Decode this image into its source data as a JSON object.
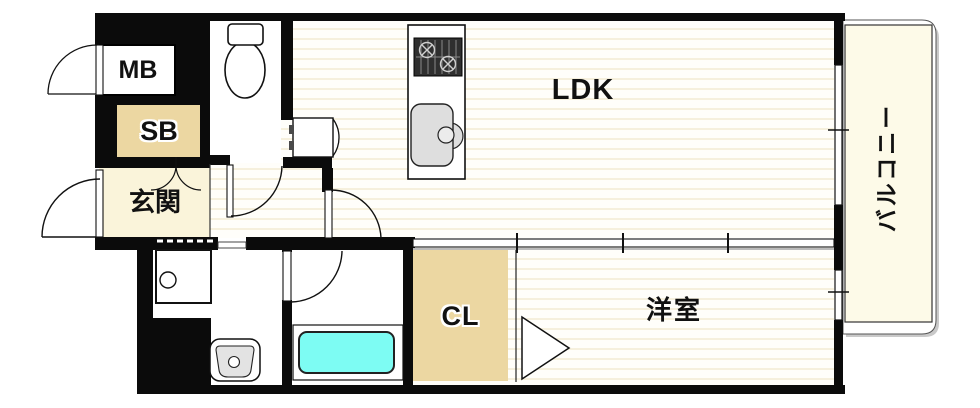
{
  "floorplan": {
    "unit_labels": {
      "mb": "MB",
      "sb": "SB",
      "genkan": "玄関",
      "ldk": "LDK",
      "balcony": "バルコニー",
      "cl": "CL",
      "western_room": "洋室"
    },
    "colors": {
      "wall": "#0b0b0b",
      "genkan_floor": "#faf4da",
      "storage_fill": "#ecd7a2",
      "balcony_floor": "#fdfae8",
      "bathtub": "#7dfcf3",
      "flooring_stripe": "#f6f0dd",
      "fixture_gray": "#dedede"
    }
  }
}
